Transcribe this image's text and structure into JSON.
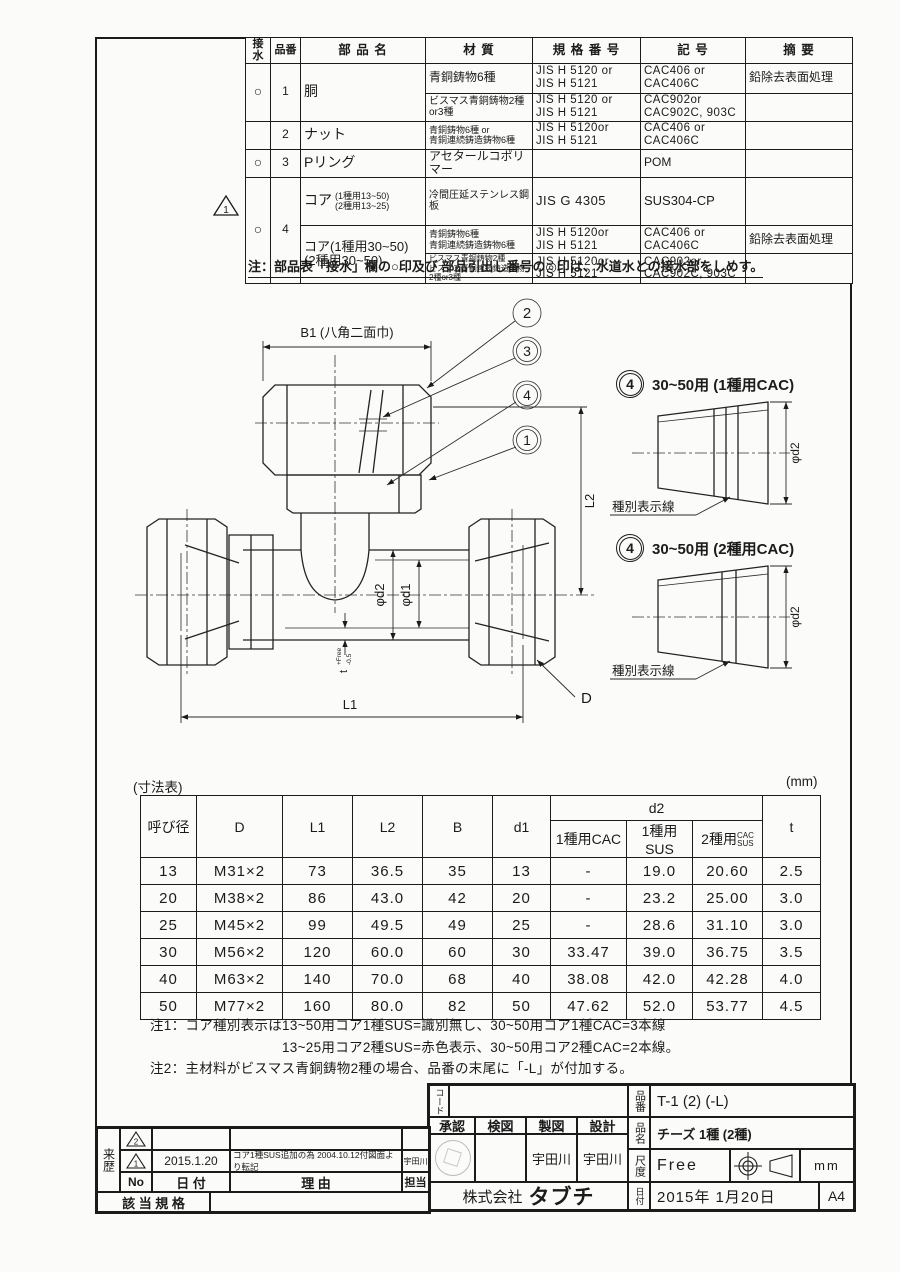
{
  "parts_table": {
    "headers": {
      "sessui": "接水",
      "hinban": "品番",
      "name": "部 品 名",
      "mat": "材  質",
      "std": "規 格 番 号",
      "sym": "記  号",
      "rem": "摘  要"
    },
    "r1": {
      "sessui": "○",
      "no": "1",
      "name": "胴",
      "a": {
        "mat": "青銅鋳物6種",
        "std": "JIS H 5120 or\nJIS H 5121",
        "sym": "CAC406 or\nCAC406C",
        "rem": "鉛除去表面処理"
      },
      "b": {
        "mat": "ビスマス青銅鋳物2種or3種",
        "std": "JIS H 5120 or\nJIS H 5121",
        "sym": "CAC902or\nCAC902C, 903C",
        "rem": ""
      }
    },
    "r2": {
      "sessui": "",
      "no": "2",
      "name": "ナット",
      "mat": "青銅鋳物6種 or\n青銅連続鋳造鋳物6種",
      "std": "JIS H 5120or\nJIS H 5121",
      "sym": "CAC406 or\nCAC406C",
      "rem": ""
    },
    "r3": {
      "sessui": "○",
      "no": "3",
      "name": "Pリング",
      "mat": "アセタールコポリマー",
      "std": "",
      "sym": "POM",
      "rem": ""
    },
    "r4": {
      "mark": "1",
      "sessui": "○",
      "no": "4",
      "name_a": "コア",
      "name_a_sub": "(1種用13~50)\n(2種用13~25)",
      "name_b": "コア(1種用30~50)\n(2種用30~50)",
      "a": {
        "mat": "冷間圧延ステンレス鋼板",
        "std": "JIS G 4305",
        "sym": "SUS304-CP",
        "rem": ""
      },
      "b": {
        "mat": "青銅鋳物6種\n青銅連続鋳造鋳物6種",
        "std": "JIS H 5120or\nJIS H 5121",
        "sym": "CAC406 or\nCAC406C",
        "rem": "鉛除去表面処理"
      },
      "c": {
        "mat": "ビスマス青銅鋳物2種\nビスマス青銅連続鋳造鋳物2種or3種",
        "std": "JIS H 5120or\nJIS H 5121",
        "sym": "CAC902or\nCAC902C, 903C",
        "rem": ""
      }
    },
    "note": "注：部品表「接水」欄の○印及び 部品引出し番号の◎印は、水道水との接水部をしめす。"
  },
  "drawing": {
    "b1": "B1 (八角二面巾)",
    "balloon_2": "2",
    "balloon_3": "3",
    "balloon_4": "4",
    "balloon_1": "1",
    "l2": "L2",
    "l1": "L1",
    "d": "D",
    "phi_d2": "φd2",
    "phi_d1": "φd1",
    "t": "t",
    "t_up": "+Free",
    "t_dn": "-0.5",
    "details": [
      {
        "num": "4",
        "label": "30~50用 (1種用CAC)",
        "dim": "φd2",
        "note": "種別表示線"
      },
      {
        "num": "4",
        "label": "30~50用 (2種用CAC)",
        "dim": "φd2",
        "note": "種別表示線"
      }
    ]
  },
  "dim_table": {
    "caption": "(寸法表)",
    "unit": "(mm)",
    "col_headers": [
      "呼び径",
      "D",
      "L1",
      "L2",
      "B",
      "d1"
    ],
    "d2_header": "d2",
    "d2_sub1": "1種用CAC",
    "d2_sub2": "1種用SUS",
    "d2_sub3_prefix": "2種用",
    "d2_sub3_stack1": "CAC",
    "d2_sub3_stack2": "SUS",
    "t_header": "t",
    "rows": [
      [
        "13",
        "M31×2",
        "73",
        "36.5",
        "35",
        "13",
        "-",
        "19.0",
        "20.60",
        "2.5"
      ],
      [
        "20",
        "M38×2",
        "86",
        "43.0",
        "42",
        "20",
        "-",
        "23.2",
        "25.00",
        "3.0"
      ],
      [
        "25",
        "M45×2",
        "99",
        "49.5",
        "49",
        "25",
        "-",
        "28.6",
        "31.10",
        "3.0"
      ],
      [
        "30",
        "M56×2",
        "120",
        "60.0",
        "60",
        "30",
        "33.47",
        "39.0",
        "36.75",
        "3.5"
      ],
      [
        "40",
        "M63×2",
        "140",
        "70.0",
        "68",
        "40",
        "38.08",
        "42.0",
        "42.28",
        "4.0"
      ],
      [
        "50",
        "M77×2",
        "160",
        "80.0",
        "82",
        "50",
        "47.62",
        "52.0",
        "53.77",
        "4.5"
      ]
    ]
  },
  "notes": {
    "n1a": "注1：コア種別表示は13~50用コア1種SUS=識別無し、30~50用コア1種CAC=3本線",
    "n1b": "13~25用コア2種SUS=赤色表示、30~50用コア2種CAC=2本線。",
    "n2": "注2：主材料がビスマス青銅鋳物2種の場合、品番の末尾に「-L」が付加する。"
  },
  "title_block": {
    "code_label": "コード",
    "part_no_label": "品番",
    "part_no": "T-1 (2) (-L)",
    "approve": "承認",
    "check": "検図",
    "draft": "製図",
    "design": "設計",
    "draft_name": "宇田川",
    "design_name": "宇田川",
    "part_name_label": "品名",
    "part_name": "チーズ 1種 (2種)",
    "scale_label": "尺度",
    "scale": "Free",
    "unit": "mm",
    "company_prefix": "株式会社",
    "company_name": "タブチ",
    "date_label": "日付",
    "date": "2015年 1月20日",
    "sheet": "A4"
  },
  "revision": {
    "label": "来歴",
    "r1_no": "2",
    "r1_date": "",
    "r1_reason": "",
    "r1_tanto": "",
    "r2_no": "1",
    "r2_date": "2015.1.20",
    "r2_reason": "コア1種SUS追加の為 2004.10.12付図面より転記",
    "r2_tanto": "宇田川",
    "h_no": "No",
    "h_date": "日 付",
    "h_reason": "理  由",
    "h_tanto": "担当",
    "standard_label": "該 当 規 格",
    "standard_value": "",
    "warn_no": "1"
  }
}
